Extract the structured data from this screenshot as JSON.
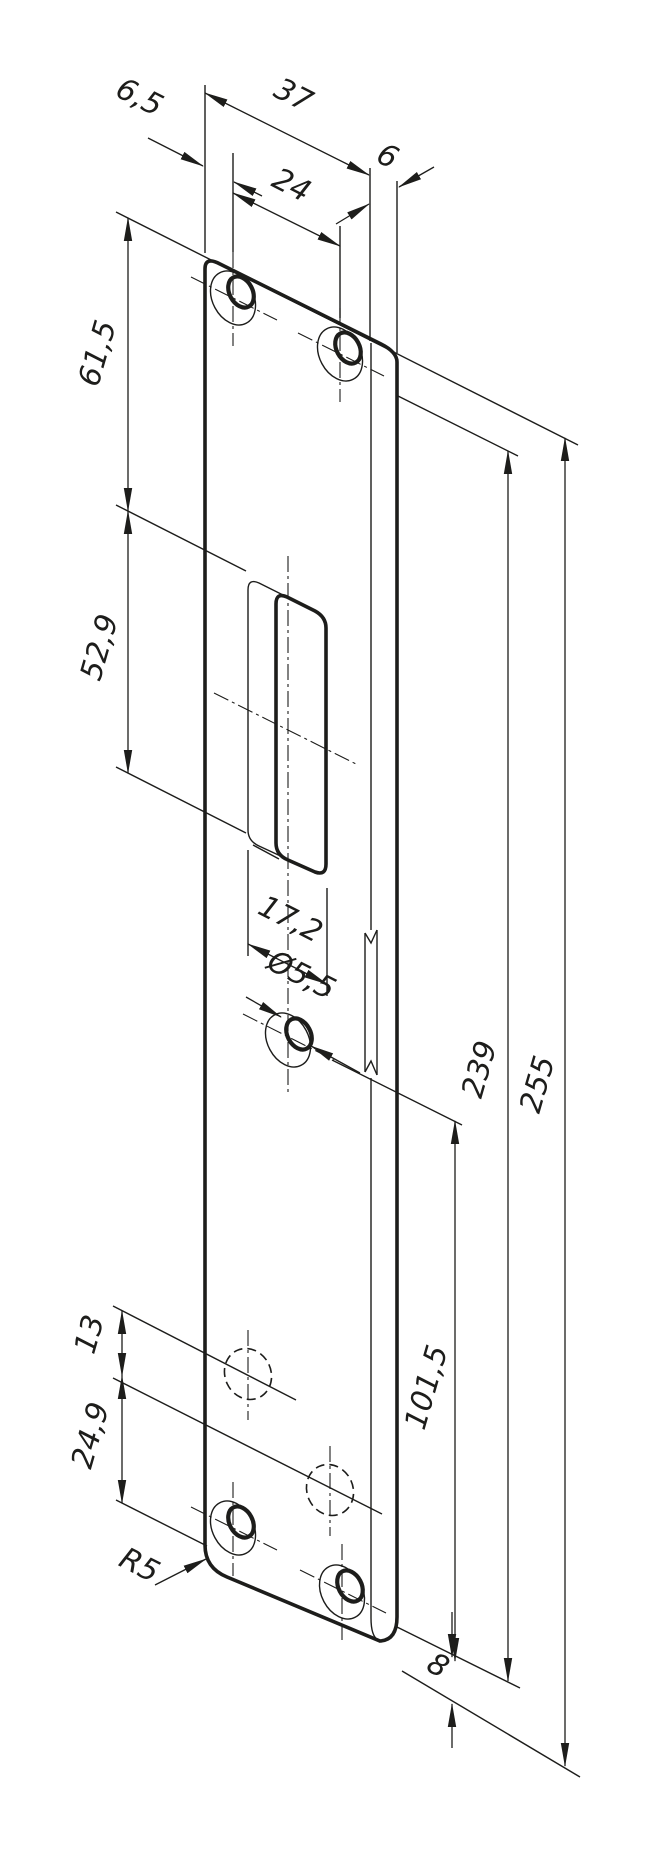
{
  "drawing": {
    "kind": "technical-dimension-drawing",
    "part": "strike-plate"
  },
  "colors": {
    "line": "#1d1d1b",
    "background": "#ffffff"
  },
  "dims": {
    "plate_width": "37",
    "top_hole_spacing": "24",
    "edge_to_hole": "6,5",
    "lip_width": "6",
    "top_to_cutout": "61,5",
    "cutout_length": "52,9",
    "cutout_width": "17,2",
    "hole_diameter": "Ø5,5",
    "hidden_hole_spacing": "13",
    "bottom_section": "24,9",
    "corner_radius": "R5",
    "face_length": "239",
    "total_length": "255",
    "hole_to_bottom": "101,5",
    "lip_overhang": "8"
  }
}
